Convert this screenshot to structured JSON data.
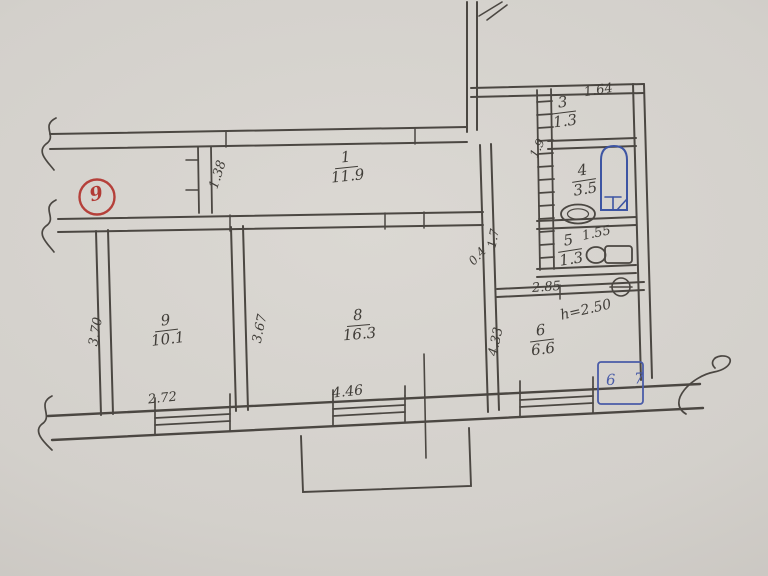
{
  "plan": {
    "sheet_mark": "9",
    "rooms": [
      {
        "number": "1",
        "area": "11.9"
      },
      {
        "number": "3",
        "area": "1.3"
      },
      {
        "number": "4",
        "area": "3.5"
      },
      {
        "number": "5",
        "area": "1.3"
      },
      {
        "number": "6",
        "area": "6.6"
      },
      {
        "number": "8",
        "area": "16.3"
      },
      {
        "number": "9",
        "area": "10.1"
      }
    ],
    "dims": {
      "hall_partition": "1.38",
      "closet_width": "1.64",
      "bath_depth": "1.9",
      "wc_width": "1.55",
      "gap_a": "1.7",
      "gap_b": "0.4",
      "kitchen_width": "2.85",
      "kitchen_depth": "4.33",
      "room9_depth": "3.70",
      "room8_depth": "3.67",
      "room9_width": "2.72",
      "room8_width": "4.46",
      "ceiling_height": "h=2.50"
    },
    "stamp_text": "6 7",
    "colors": {
      "pencil": "#4b4742",
      "blue": "#3d55a3",
      "red": "#b5403a",
      "paper": "#d3d0cb"
    }
  }
}
